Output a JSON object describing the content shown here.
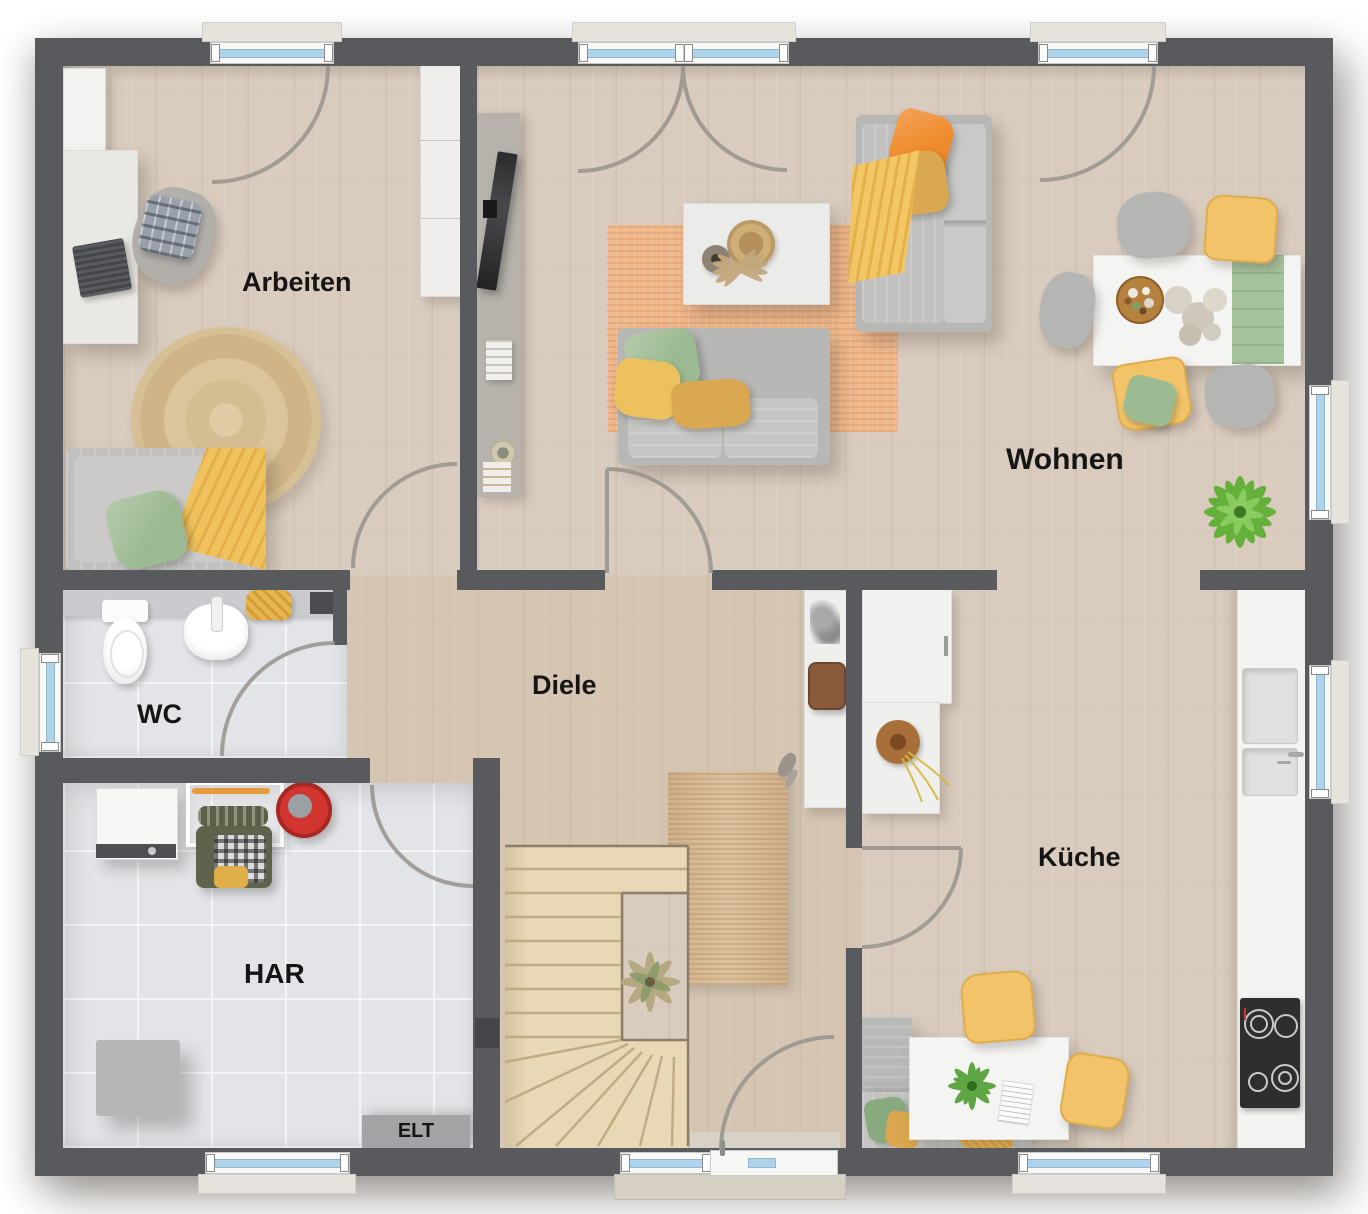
{
  "rooms": [
    {
      "id": "arbeiten",
      "label": "Arbeiten"
    },
    {
      "id": "wohnen",
      "label": "Wohnen"
    },
    {
      "id": "wc",
      "label": "WC"
    },
    {
      "id": "diele",
      "label": "Diele"
    },
    {
      "id": "kueche",
      "label": "Küche"
    },
    {
      "id": "har",
      "label": "HAR"
    },
    {
      "id": "elt",
      "label": "ELT"
    }
  ],
  "colors": {
    "wall": "#595a5e",
    "wood_floor": "#d9ccbe",
    "tile_floor": "#e3e4e7",
    "window_glass": "#aed3ea",
    "living_rug": "#efb88d",
    "jute_rug": "#d8bc95",
    "sofa_gray": "#bcbcba",
    "accent_yellow": "#eec15f",
    "accent_orange": "#ef8b2c",
    "accent_green": "#9cba91",
    "label_text": "#151515"
  }
}
